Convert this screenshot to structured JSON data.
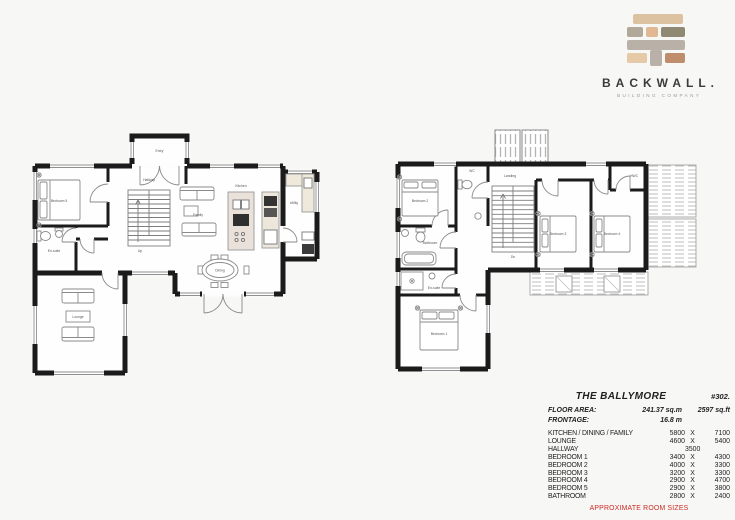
{
  "page": {
    "background": "#f7f7f6",
    "accent_red": "#ce2b24"
  },
  "logo": {
    "brand": "BACKWALL.",
    "tagline": "BUILDING COMPANY",
    "brick_colors": [
      "#ddc2a1",
      "#b2a89a",
      "#e2b894",
      "#8f8a71",
      "#b9b1a7",
      "#e6c9a6",
      "#bf8c6c"
    ]
  },
  "plans": {
    "ground": {
      "labels": {
        "entry": "Entry",
        "bedroom5": "Bedroom 5",
        "ensuite": "En-suite",
        "hallway": "Hallway",
        "family": "Family",
        "kitchen": "Kitchen",
        "utility": "Utility",
        "dining": "Dining",
        "lounge": "Lounge",
        "up": "Up"
      }
    },
    "first": {
      "labels": {
        "landing": "Landing",
        "wc": "WC",
        "hwc": "HWC",
        "bedroom1": "Bedroom 1",
        "bedroom2": "Bedroom 2",
        "bedroom3": "Bedroom 3",
        "bedroom4": "Bedroom 4",
        "bathroom": "Bathroom",
        "ensuite": "En-suite",
        "dn": "Dn"
      }
    }
  },
  "spec_table": {
    "title": "THE BALLYMORE",
    "plan_number": "#302.",
    "floor_area_label": "FLOOR AREA:",
    "floor_area_sqm": "241.37 sq.m",
    "floor_area_sqft": "2597 sq.ft",
    "frontage_label": "FRONTAGE:",
    "frontage_value": "16.8 m",
    "rooms": [
      {
        "name": "KITCHEN / DINING / FAMILY",
        "c1": "5800",
        "c2": "X",
        "c3": "7100"
      },
      {
        "name": "LOUNGE",
        "c1": "4600",
        "c2": "X",
        "c3": "5400"
      },
      {
        "name": "HALLWAY",
        "c1": "",
        "c2": "3500",
        "c3": ""
      },
      {
        "name": "BEDROOM 1",
        "c1": "3400",
        "c2": "X",
        "c3": "4300"
      },
      {
        "name": "BEDROOM 2",
        "c1": "4000",
        "c2": "X",
        "c3": "3300"
      },
      {
        "name": "BEDROOM 3",
        "c1": "3200",
        "c2": "X",
        "c3": "3300"
      },
      {
        "name": "BEDROOM 4",
        "c1": "2900",
        "c2": "X",
        "c3": "4700"
      },
      {
        "name": "BEDROOM 5",
        "c1": "2900",
        "c2": "X",
        "c3": "3800"
      },
      {
        "name": "BATHROOM",
        "c1": "2800",
        "c2": "X",
        "c3": "2400"
      }
    ],
    "footnote": "APPROXIMATE ROOM SIZES"
  }
}
